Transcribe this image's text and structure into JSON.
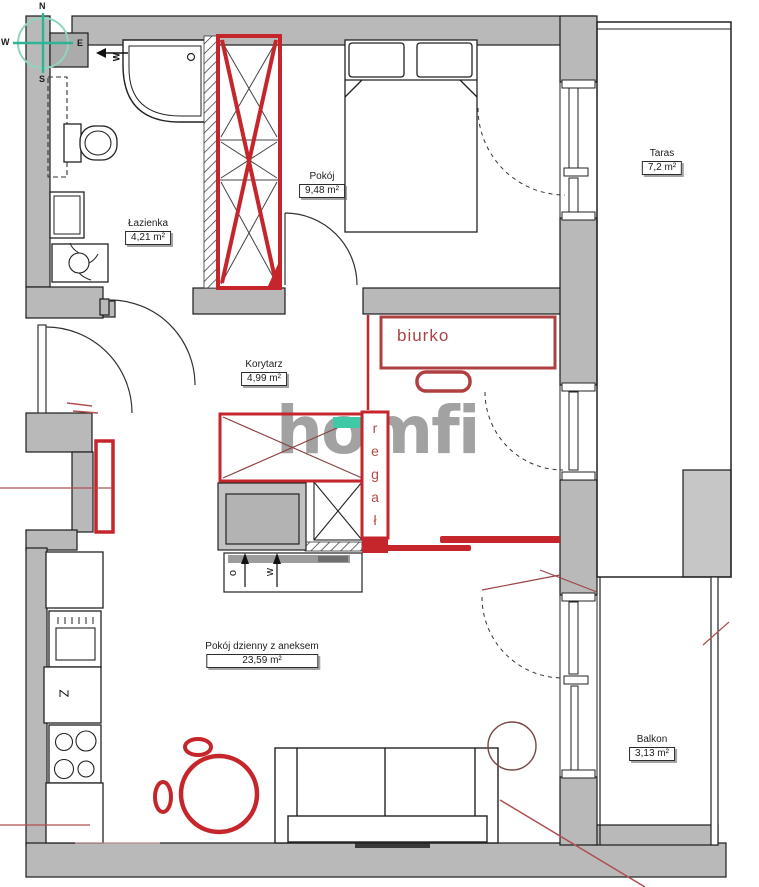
{
  "plan": {
    "watermark": "homfi",
    "compass": {
      "north": "N",
      "east": "E",
      "south": "S",
      "west": "W"
    },
    "vent_label": "W",
    "rooms": [
      {
        "name": "Łazienka",
        "area": "4,21 m²"
      },
      {
        "name": "Pokój",
        "area": "9,48 m²"
      },
      {
        "name": "Taras",
        "area": "7,2 m²"
      },
      {
        "name": "Korytarz",
        "area": "4,99 m²"
      },
      {
        "name": "Pokój dzienny z aneksem",
        "area": "23,59 m²"
      },
      {
        "name": "Balkon",
        "area": "3,13 m²"
      }
    ],
    "annotations": {
      "desk": "biurko",
      "bookshelf": "regał"
    },
    "kitchen": {
      "dishwasher": "Z",
      "counter_marks": [
        "o",
        "w"
      ]
    },
    "colors": {
      "annotation_red": "#c5262c",
      "wall_gray": "#b9b9b9",
      "teal_highlight": "#3fc9a6",
      "compass_green": "#2eb394",
      "watermark_gray": "#9e9e9e"
    }
  }
}
